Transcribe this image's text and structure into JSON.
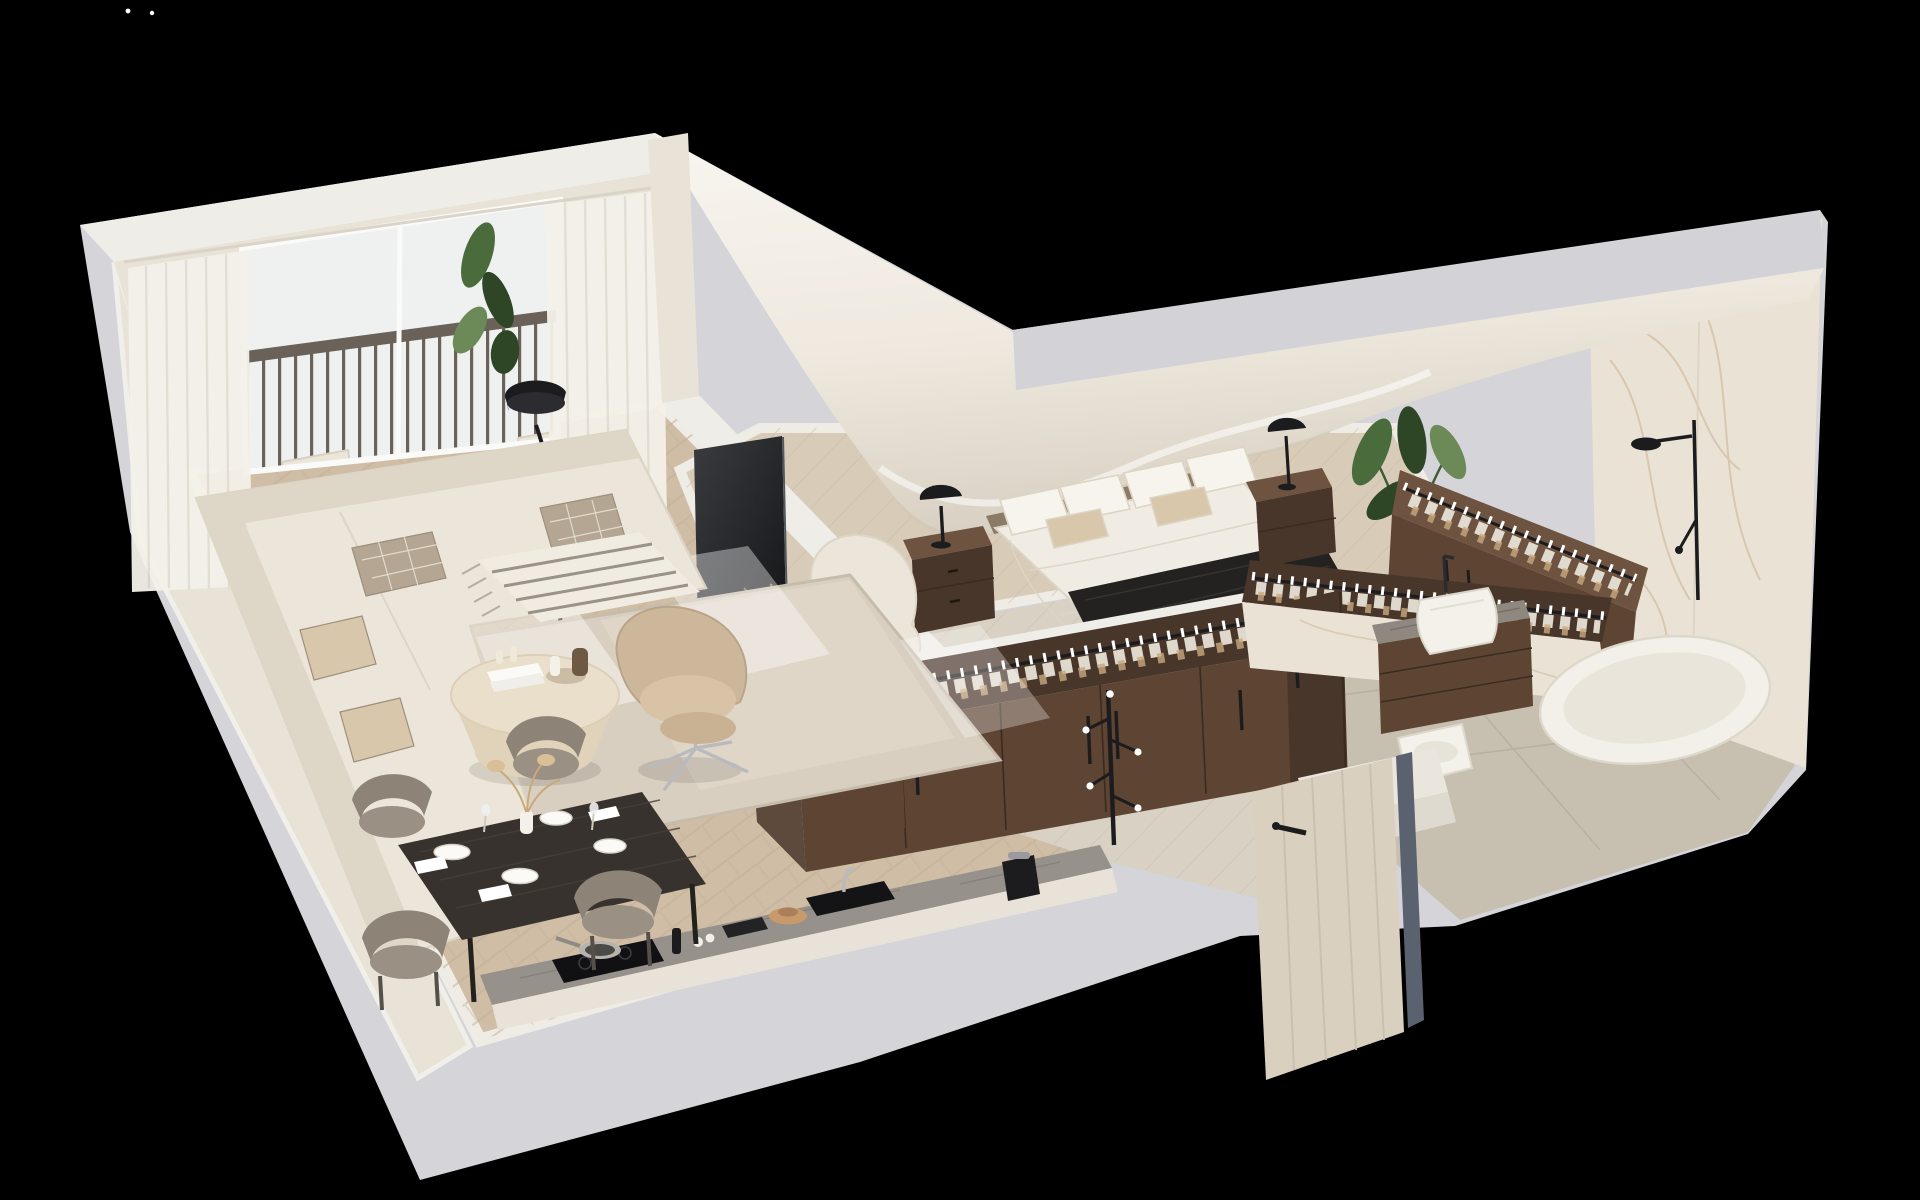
{
  "meta": {
    "title": "3D isometric cutaway floor plan render of a one-bedroom attic apartment",
    "style": "photorealistic architectural visualization on black background",
    "view": "axonometric cutaway from above"
  },
  "palette": {
    "background": "#000000",
    "speck": "#ffffff",
    "slab": "#d4d4d9",
    "wall-top": "#efede8",
    "wall-face": "#e9e2d7",
    "band-gray": "#d2d2d7",
    "swoosh-light": "#f7f4ee",
    "swoosh-dark": "#d9d1c3",
    "glass": "#eef1f0",
    "curtain": "#f4f1ea",
    "deck": "#c2935f",
    "deck-line": "#a87c50",
    "rail": "#6a6158",
    "floor-living": "#cfbda6",
    "floor-living-line": "#bfab92",
    "floor-bedroom": "#d8ccb9",
    "floor-hall": "#d9d1c3",
    "floor-bath": "#c7bfb0",
    "rug": "#d9cfc0",
    "rug-line": "#c6bcab",
    "sofa": "#ece6da",
    "sofa-shadow": "#ded7c8",
    "pillow-check": "#b4a693",
    "coffee-table": "#eadfcb",
    "chair-beige": "#cdb79b",
    "dining-table": "#37322d",
    "chair-gray": "#8d8377",
    "wood-dark": "#5d4433",
    "wood-darker": "#49362a",
    "wood-light": "#6d5340",
    "black-accent": "#1c1c1e",
    "counter": "#96918b",
    "bed-white": "#f1ece3",
    "pillow-white": "#f7f4ed",
    "pillow-beige": "#d8c7ab",
    "throw-black": "#242220",
    "marble": "#eae3d5",
    "marble-vein": "#c9b190",
    "tub": "#f3f0e9",
    "sink": "#f4f1ea",
    "door-light": "#d9d0c0",
    "door-frame": "#5a6270",
    "plant-dark": "#2e4526",
    "plant-mid": "#4a6b3c",
    "plant-light": "#6b8a58",
    "chrome": "#b9babd"
  },
  "rooms": {
    "balcony": {
      "label": "Balcony with wood-tile deck, metal railing, two cream lounge chairs, slatted round side table with tea tray, privacy screen and potted plants"
    },
    "living_room": {
      "label": "Living room with cream L-shaped sectional sofa, checked cushions, striped throw, jute rug, round stone coffee table, beige swivel armchair, black floor lamp, wall TV above floating walnut media console, sheer floor-to-ceiling curtains"
    },
    "dining": {
      "label": "Black dining table set for four with grey curved chairs, plates, napkins, glasses and pampas vase"
    },
    "kitchen": {
      "label": "Kitchen run along cut wall with stone counter, induction cooktop with frying pan, black under-mount sink, coffee machine, cutting board and tall walnut cabinet"
    },
    "bedroom": {
      "label": "Attic bedroom under curved sloped roof with double bed, white bedding, beige pillows, black fringed throw, two walnut nightstands with black mushroom lamps, cream lounge pouf and potted plant"
    },
    "wardrobe": {
      "label": "L-shaped open walnut wardrobes full of hanging clothes on rails, plus sloped-top wardrobe under the roof and a black coat stand in the hallway"
    },
    "bathroom": {
      "label": "Marble bathroom with floating walnut vanity, white vessel sink, freestanding oval bathtub, black shower set, toilet and entry step"
    },
    "entry": {
      "label": "Entry hall with whitewashed wood front door, dark slate door frame and open walnut interior door"
    }
  }
}
